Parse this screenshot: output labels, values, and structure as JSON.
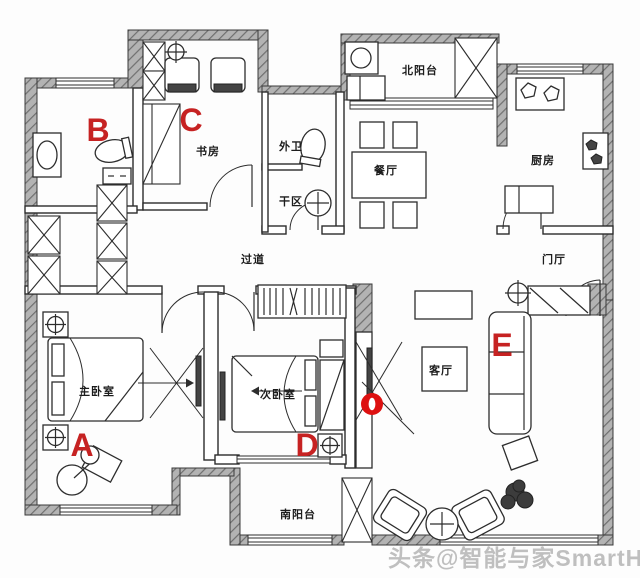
{
  "plan": {
    "type": "apartment-floor-plan",
    "rooms": {
      "study": "书房",
      "guest_wc": "外卫",
      "dry_area": "干区",
      "dining": "餐厅",
      "north_balcony": "北阳台",
      "kitchen": "厨房",
      "foyer": "门厅",
      "hallway": "过道",
      "master_bedroom": "主卧室",
      "second_bedroom": "次卧室",
      "south_balcony": "南阳台",
      "living_room": "客厅"
    },
    "markers": {
      "a": "A",
      "b": "B",
      "c": "C",
      "d": "D",
      "e": "E"
    },
    "colors": {
      "marker_red": "#c62222",
      "wall_gray": "#b3b3b3",
      "line_dark": "#2d2d2d",
      "watermark_gray": "#bfbfbf"
    },
    "watermark": "头条@智能与家SmartHome"
  }
}
